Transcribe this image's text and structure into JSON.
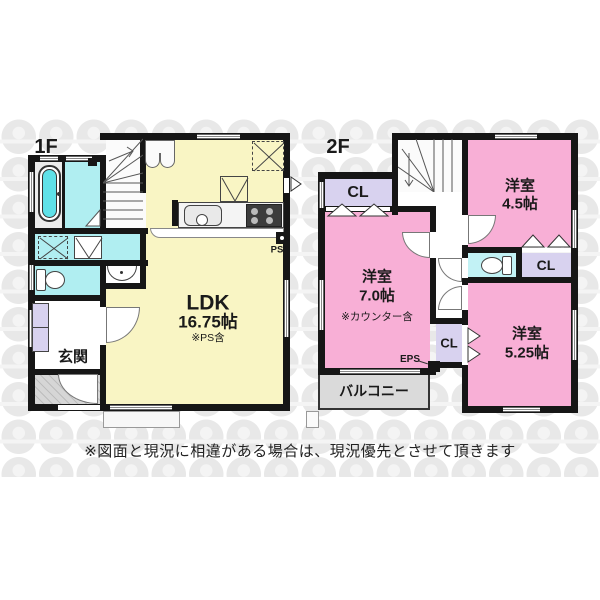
{
  "document_type": "floor-plan",
  "colors": {
    "wall": "#161616",
    "ldk_fill": "#f9f5c4",
    "bedroom_fill": "#f8afd6",
    "wet_area_fill": "#b0eef1",
    "closet_fill": "#d8d2ef",
    "balcony_fill": "#dadada",
    "watermark": "#e8e8e8"
  },
  "floor1": {
    "label": "1F",
    "ldk": {
      "name": "LDK",
      "size": "16.75帖",
      "note": "※PS含"
    },
    "genkan": "玄関",
    "ps": "PS"
  },
  "floor2": {
    "label": "2F",
    "room45": {
      "name": "洋室",
      "size": "4.5帖"
    },
    "room70": {
      "name": "洋室",
      "size": "7.0帖",
      "note": "※カウンター含"
    },
    "room525": {
      "name": "洋室",
      "size": "5.25帖"
    },
    "cl_nw": "CL",
    "cl_ne": "CL",
    "cl_mid": "CL",
    "eps": "EPS",
    "balcony": "バルコニー"
  },
  "disclaimer": "※図面と現況に相違がある場合は、現況優先とさせて頂きます"
}
